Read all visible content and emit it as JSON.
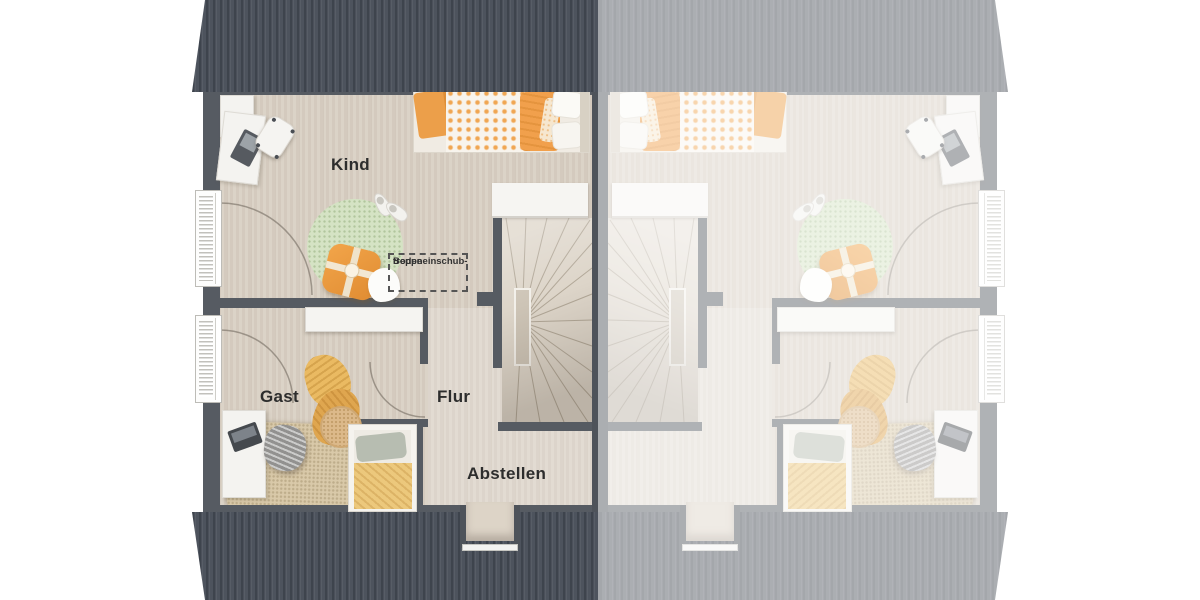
{
  "floorplan": {
    "type": "attic floor plan of a semi-detached house, left unit rendered, right unit mirrored and faded",
    "room_labels": {
      "kind": "Kind",
      "gast": "Gast",
      "flur": "Flur",
      "abstellen": "Abstellen"
    },
    "attic_ladder_annotation": {
      "line1": "Bodeneinschub-",
      "line2": "treppe"
    },
    "colors": {
      "roof_dark": "#4d535d",
      "roof_faded": "#a9aeb6",
      "wall": "#565b62",
      "floor": "#d9d0c4",
      "rug_green": "#d5e3c4",
      "rug_beige": "#d9c9a9",
      "accent_orange": "#ec9f4a",
      "blanket_yellow": "#eaba62",
      "furniture_white": "#f5f4f1",
      "label_text": "#2d2d2d",
      "fade_overlay": "rgba(255,255,255,0.53)"
    }
  }
}
